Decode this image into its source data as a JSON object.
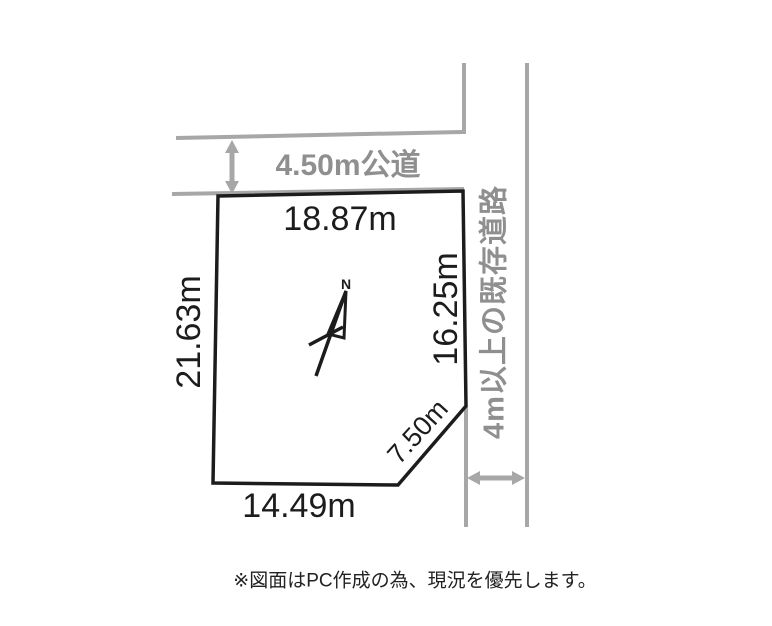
{
  "diagram": {
    "roads": {
      "top_label": "4.50m公道",
      "right_label": "4m以上の既存道路"
    },
    "plot": {
      "dim_top": "18.87m",
      "dim_left": "21.63m",
      "dim_right": "16.25m",
      "dim_bottom": "14.49m",
      "dim_diagonal": "7.50m"
    },
    "compass": {
      "label": "N"
    },
    "note": "※図面はPC作成の為、現況を優先します。",
    "colors": {
      "plot_outline": "#1c1c1c",
      "road_line": "#a7a7a7",
      "road_text": "#8f8f8f",
      "dim_text": "#1c1c1c"
    }
  }
}
